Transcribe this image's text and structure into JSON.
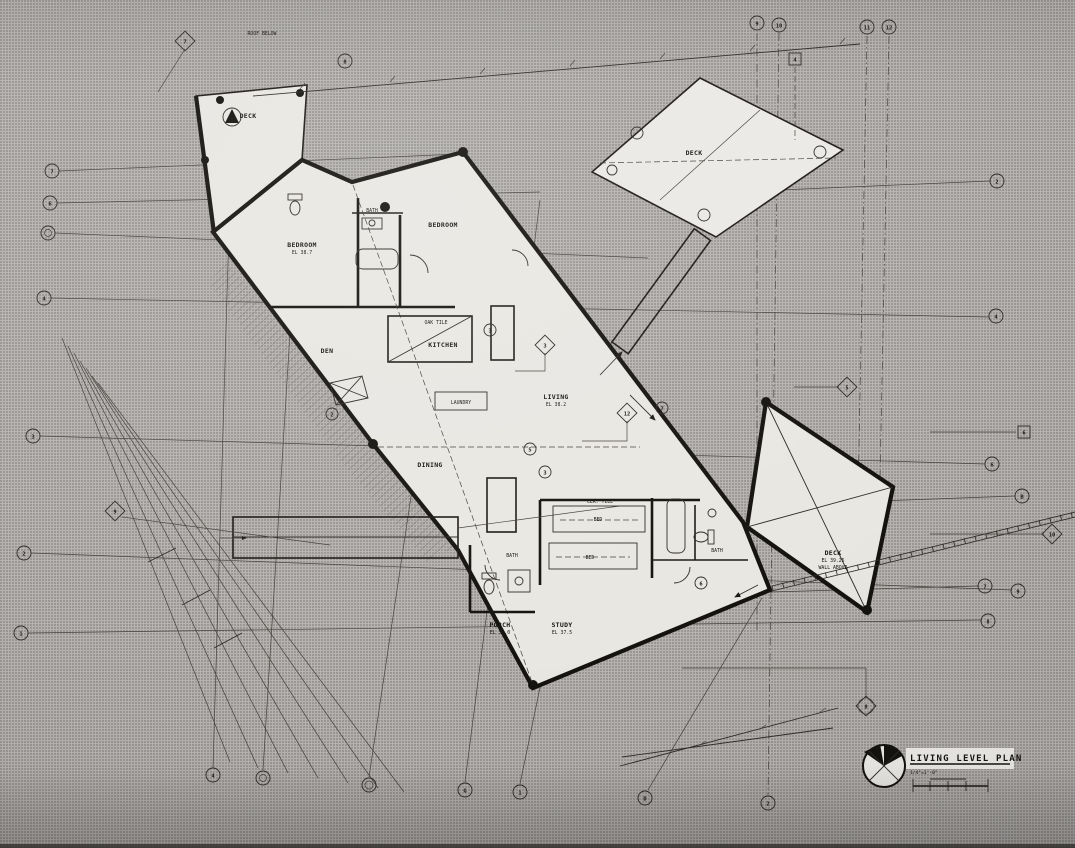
{
  "title_block": {
    "title": "LIVING LEVEL PLAN",
    "scale": "1/4\"=1'-0\""
  },
  "rooms": [
    {
      "label": "DECK"
    },
    {
      "label": "BEDROOM",
      "sub": "EL 38.7"
    },
    {
      "label": "BATH"
    },
    {
      "label": "BEDROOM"
    },
    {
      "label": "OAK TILE"
    },
    {
      "label": "KITCHEN"
    },
    {
      "label": "DEN"
    },
    {
      "label": "LAUNDRY"
    },
    {
      "label": "LIVING",
      "sub": "EL 38.2"
    },
    {
      "label": "DINING"
    },
    {
      "label": "BED"
    },
    {
      "label": "BED"
    },
    {
      "label": "BATH"
    },
    {
      "label": "PORCH",
      "sub": "EL 37.0"
    },
    {
      "label": "STUDY",
      "sub": "EL 37.5"
    },
    {
      "label": "BATH"
    },
    {
      "label": "DECK",
      "sub": "EL 39.25",
      "sub2": "WALL ABOVE"
    },
    {
      "label": "DECK"
    },
    {
      "label": "ROOF BELOW"
    },
    {
      "label": "CER. TILE"
    }
  ],
  "bubbles": {
    "left": [
      "7",
      "6",
      "5",
      "4",
      "3",
      "2",
      "1"
    ],
    "top": [
      "8",
      "9",
      "10",
      "11",
      "12"
    ],
    "right": [
      "2",
      "4",
      "6",
      "B",
      "7",
      "9",
      "8"
    ],
    "bottom": [
      "4",
      "B",
      "6",
      "G",
      "1",
      "D",
      "2"
    ],
    "tags": [
      "2",
      "3",
      "5",
      "7",
      "3",
      "6"
    ],
    "diamonds": [
      "7",
      "9",
      "3",
      "12",
      "5",
      "8",
      "10"
    ],
    "squares": [
      "4",
      "6"
    ]
  }
}
